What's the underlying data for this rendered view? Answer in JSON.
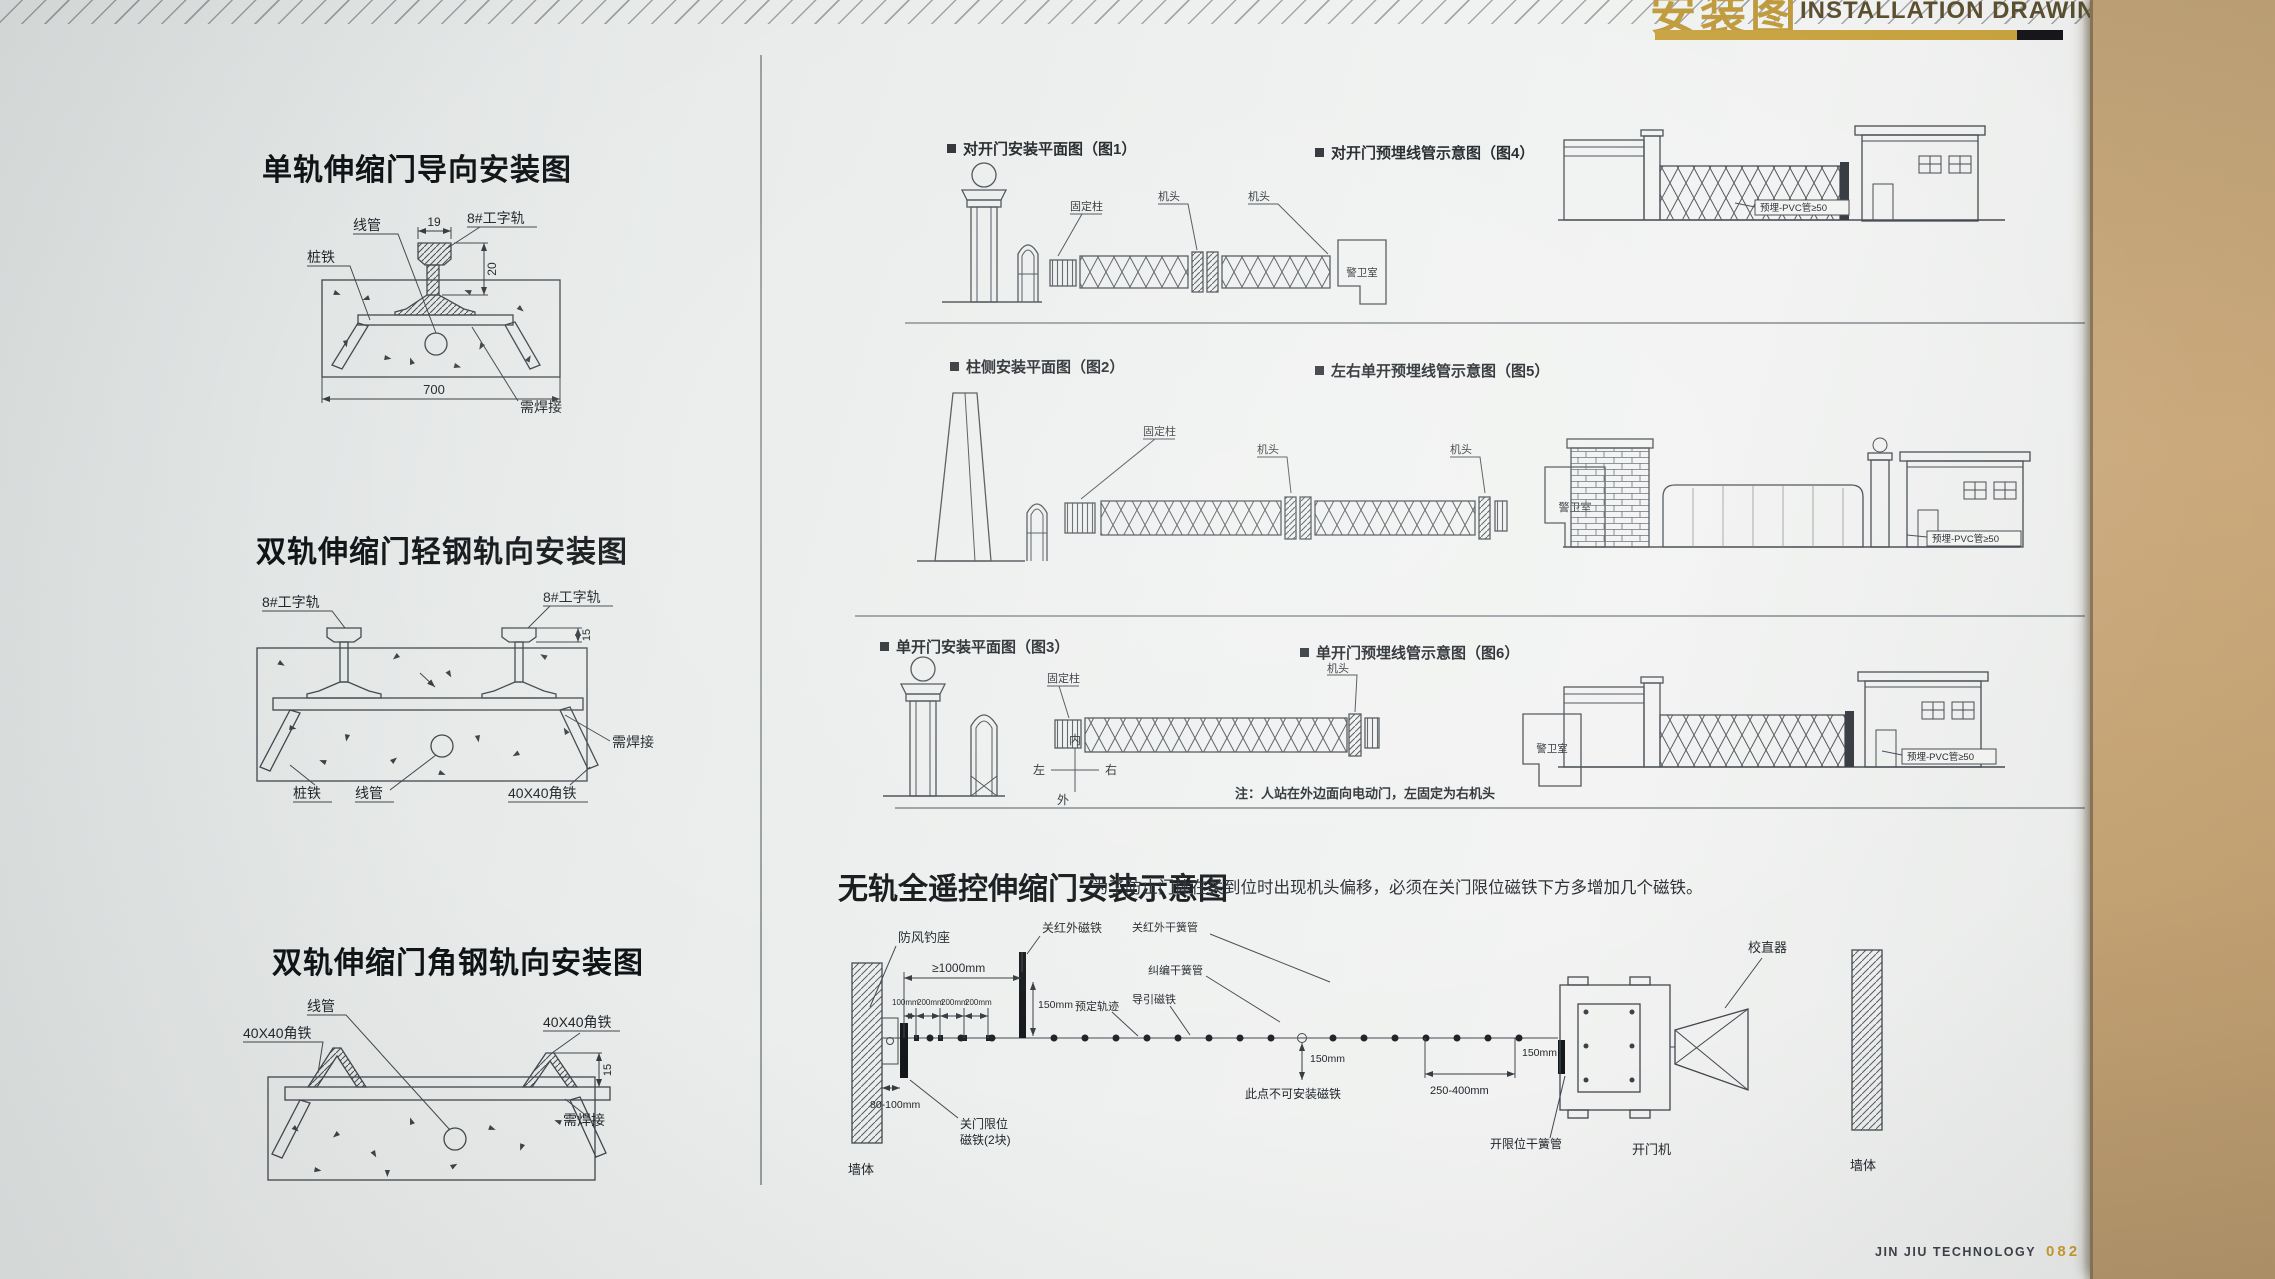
{
  "banner": {
    "title_cn": "安装图",
    "title_en": "INSTALLATION DRAWINGS"
  },
  "left": {
    "d1": {
      "title": "单轨伸缩门导向安装图",
      "conduit": "线管",
      "rail": "8#工字轨",
      "stake": "桩铁",
      "weld": "需焊接",
      "dim_top": "19",
      "dim_height": "20",
      "dim_base": "700"
    },
    "d2": {
      "title": "双轨伸缩门轻钢轨向安装图",
      "rail_left": "8#工字轨",
      "rail_right": "8#工字轨",
      "dim_height": "15",
      "weld": "需焊接",
      "stake": "桩铁",
      "conduit": "线管",
      "angle": "40X40角铁"
    },
    "d3": {
      "title": "双轨伸缩门角钢轨向安装图",
      "conduit": "线管",
      "angle_left": "40X40角铁",
      "angle_right": "40X40角铁",
      "dim_height": "15",
      "weld": "需焊接"
    }
  },
  "right": {
    "r1l": {
      "header": "对开门安装平面图（图1）",
      "fixed_post": "固定柱",
      "head_a": "机头",
      "head_b": "机头",
      "guard": "警卫室"
    },
    "r1r": {
      "header": "对开门预埋线管示意图（图4）",
      "pvc": "预埋-PVC管≥50"
    },
    "r2l": {
      "header": "柱侧安装平面图（图2）",
      "fixed_post": "固定柱",
      "head_a": "机头",
      "head_b": "机头",
      "guard": "警卫室"
    },
    "r2r": {
      "header": "左右单开预埋线管示意图（图5）",
      "pvc": "预埋-PVC管≥50"
    },
    "r3l": {
      "header": "单开门安装平面图（图3）",
      "fixed_post": "固定柱",
      "head": "机头",
      "guard": "警卫室",
      "inner": "内",
      "outer": "外",
      "left_dir": "左",
      "right_dir": "右",
      "note": "注：人站在外边面向电动门，左固定为右机头"
    },
    "r3r": {
      "header": "单开门预埋线管示意图（图6）",
      "pvc": "预埋-PVC管≥50"
    }
  },
  "trackless": {
    "title": "无轨全遥控伸缩门安装示意图",
    "note": "为了防止门体在关到位时出现机头偏移，必须在关门限位磁铁下方多增加几个磁铁。",
    "labels": {
      "wind_hook": "防风钓座",
      "close_ir_magnet": "关红外磁铁",
      "close_ir_reed": "关红外干簧管",
      "deviation_reed": "纠编干簧管",
      "straightener": "校直器",
      "planned_track": "预定轨迹",
      "guide_magnet": "导引磁铁",
      "no_magnet_here": "此点不可安装磁铁",
      "close_limit_line1": "关门限位",
      "close_limit_line2": "磁铁(2块)",
      "open_limit_reed": "开限位干簧管",
      "opener": "开门机",
      "wall_left": "墙体",
      "wall_right": "墙体"
    },
    "dims": {
      "min1000": "≥1000mm",
      "d100": "100mm",
      "d200a": "200mm",
      "d200b": "200mm",
      "d200c": "200mm",
      "d150a": "150mm",
      "d150b": "150mm",
      "d150c": "150mm",
      "d250_400": "250-400mm",
      "d80_100": "80-100mm"
    }
  },
  "footer": {
    "brand": "JIN JIU TECHNOLOGY",
    "page_no": "082"
  }
}
